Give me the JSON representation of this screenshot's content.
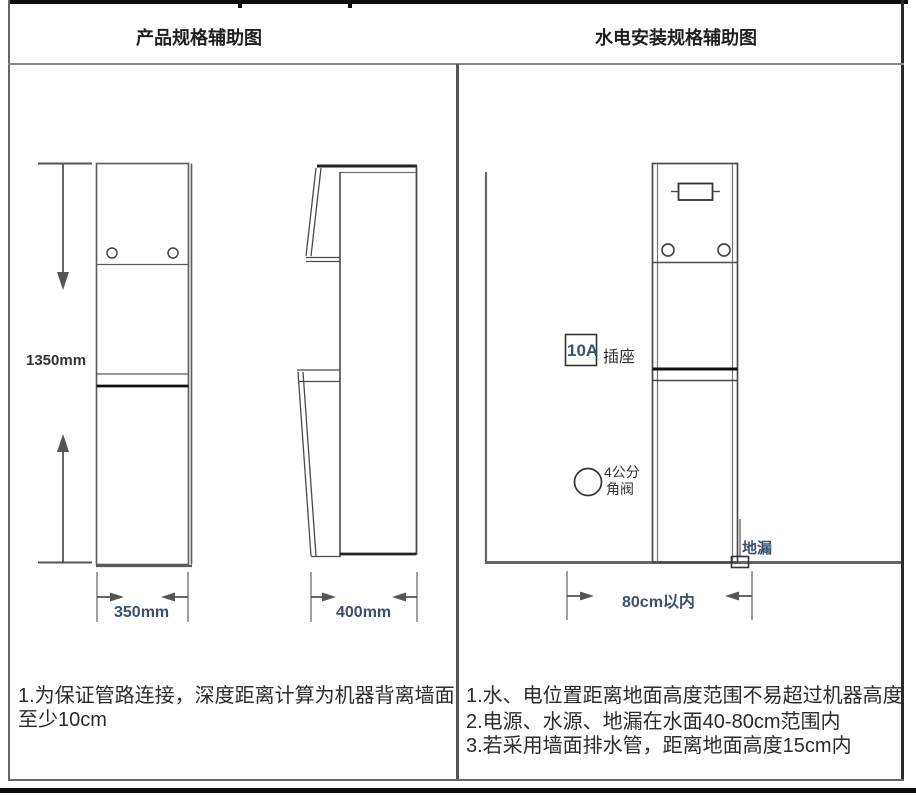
{
  "header": {
    "left_title": "产品规格辅助图",
    "right_title": "水电安装规格辅助图"
  },
  "left_panel": {
    "height_label": "1350mm",
    "width_label": "350mm",
    "depth_label": "400mm",
    "note_line1": "1.为保证管路连接，深度距离计算为机器背离墙面",
    "note_line2": "至少10cm"
  },
  "right_panel": {
    "socket_rating": "10A",
    "socket_label": "插座",
    "valve_line1": "4公分",
    "valve_line2": "角阀",
    "drain_label": "地漏",
    "distance_label": "80cm以内",
    "notes": [
      "1.水、电位置距离地面高度范围不易超过机器高度",
      "2.电源、水源、地漏在水面40-80cm范围内",
      "3.若采用墙面排水管，距离地面高度15cm内"
    ]
  },
  "colors": {
    "line_gray": "#5a5a5a",
    "line_dark": "#161616",
    "dim_text": "#3b4f70",
    "text": "#2b2b2b"
  }
}
